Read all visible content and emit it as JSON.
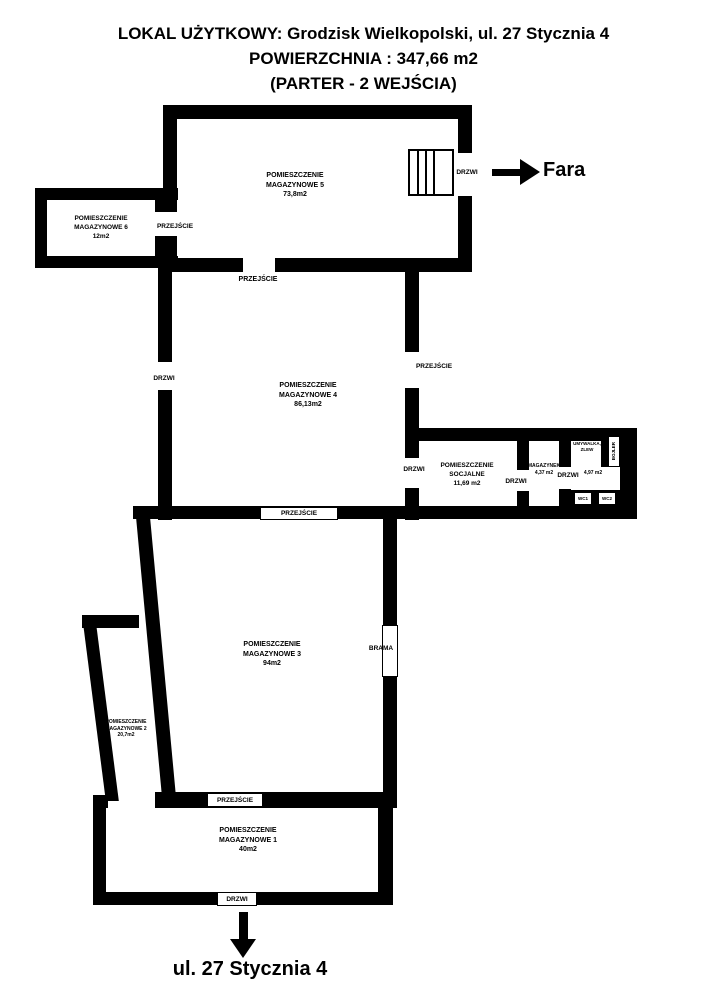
{
  "title": {
    "line1": "LOKAL UŻYTKOWY: Grodzisk Wielkopolski, ul. 27 Stycznia 4",
    "line2": "POWIERZCHNIA : 347,66 m2",
    "line3": "(PARTER - 2 WEJŚCIA)"
  },
  "labels": {
    "przejscie": "PRZEJŚCIE",
    "drzwi": "DRZWI",
    "brama": "BRAMA",
    "fara": "Fara",
    "street": "ul. 27 Stycznia 4",
    "wc1": "WC1",
    "wc2": "WC2",
    "bojler": "BOJLER",
    "umywalka": "UMYWALKA,",
    "zlew": "ZLEW"
  },
  "rooms": {
    "m5": {
      "line1": "POMIESZCZENIE",
      "line2": "MAGAZYNOWE 5",
      "area": "73,8m2"
    },
    "m6": {
      "line1": "POMIESZCZENIE",
      "line2": "MAGAZYNOWE 6",
      "area": "12m2"
    },
    "m4": {
      "line1": "POMIESZCZENIE",
      "line2": "MAGAZYNOWE 4",
      "area": "86,13m2"
    },
    "m3": {
      "line1": "POMIESZCZENIE",
      "line2": "MAGAZYNOWE 3",
      "area": "94m2"
    },
    "m2": {
      "line1": "POMIESZCZENIE",
      "line2": "MAGAZYNOWE 2",
      "area": "20,7m2"
    },
    "m1": {
      "line1": "POMIESZCZENIE",
      "line2": "MAGAZYNOWE 1",
      "area": "40m2"
    },
    "socjalne": {
      "line1": "POMIESZCZENIE",
      "line2": "SOCJALNE",
      "area": "11,69 m2"
    },
    "magazynek": {
      "line1": "MAGAZYNEK",
      "area": "4,37 m2"
    },
    "lazienka": {
      "area": "4,97 m2"
    }
  },
  "colors": {
    "wall": "#000000",
    "background": "#ffffff"
  }
}
